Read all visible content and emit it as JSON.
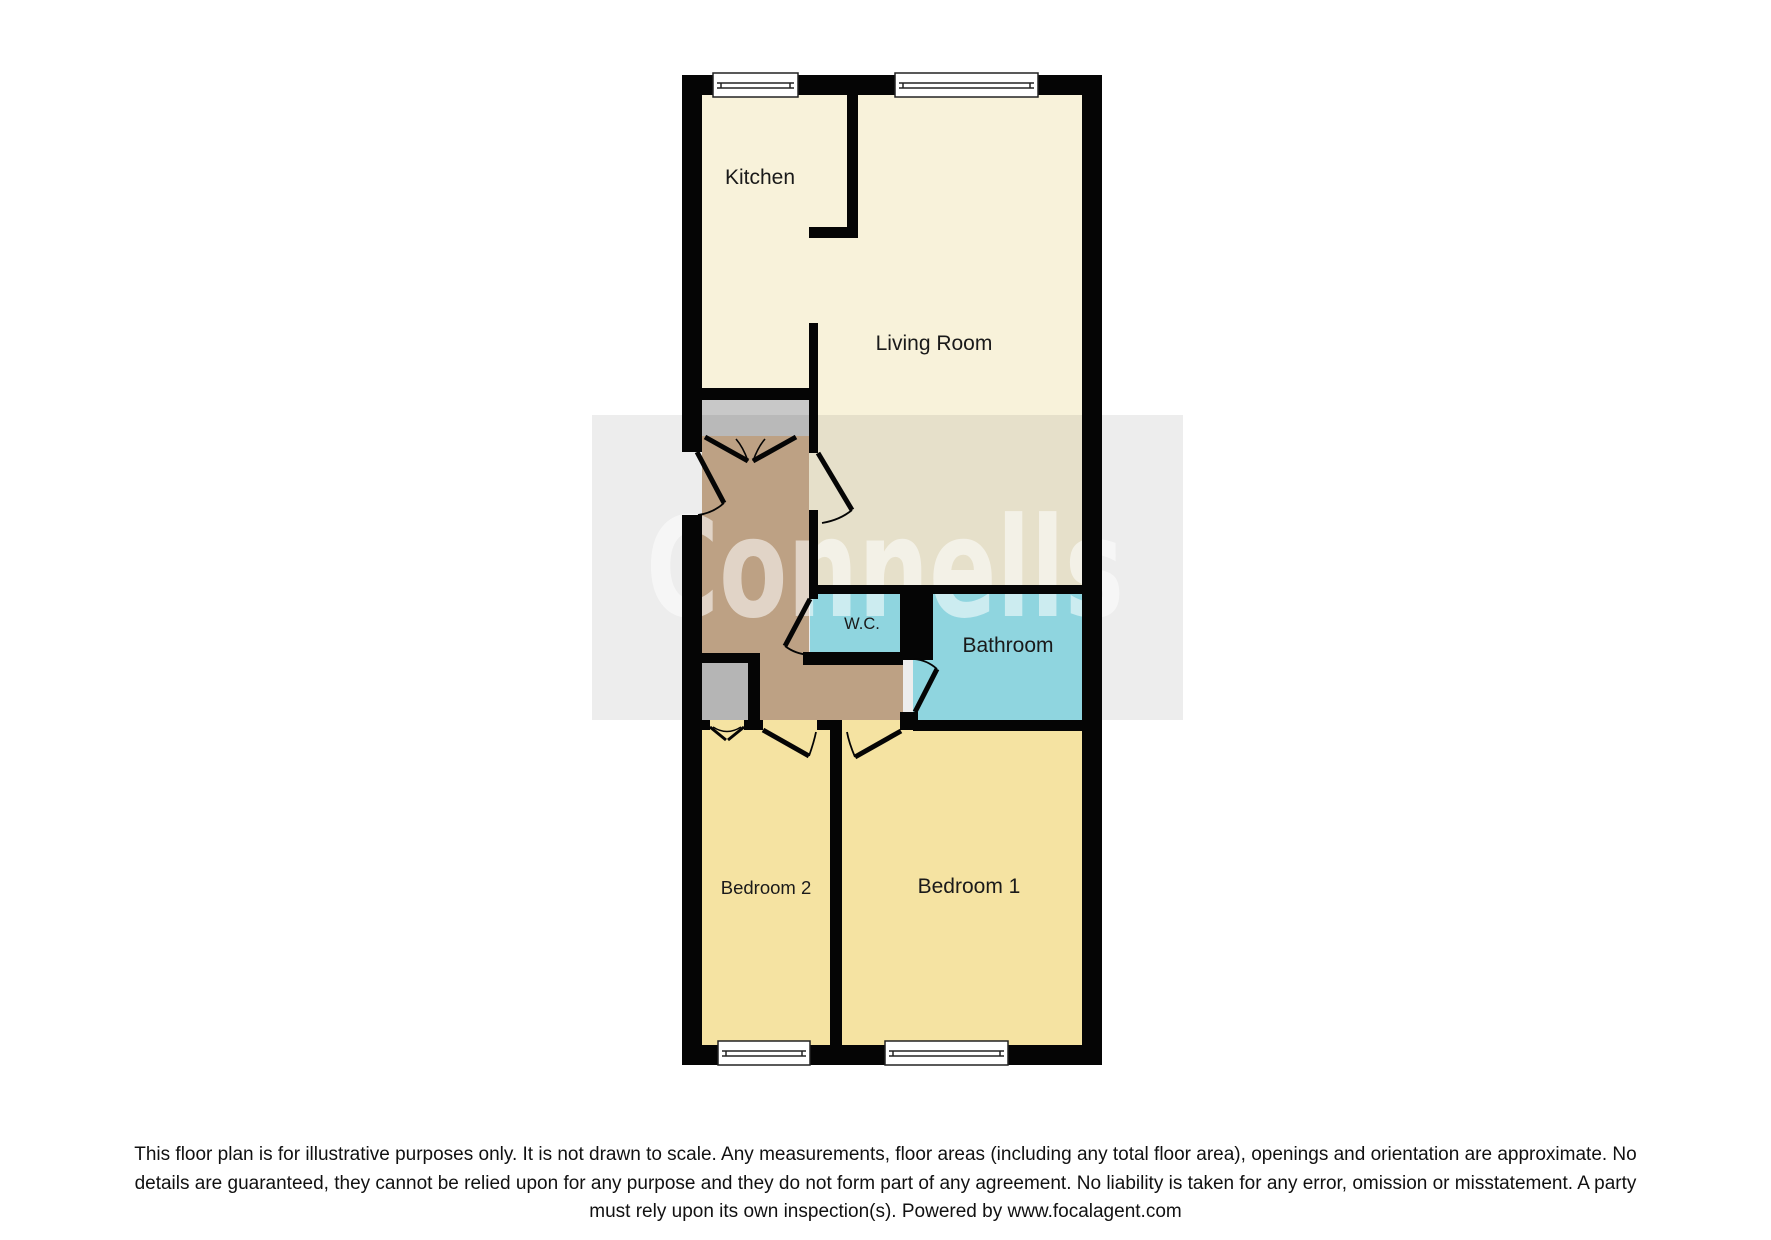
{
  "watermark": {
    "text": "Connells"
  },
  "colors": {
    "wall": "#050505",
    "cream": "#f8f2da",
    "bedroom_yellow": "#f5e3a2",
    "bath_cyan": "#9ae6f0",
    "hall_brown": "#ccae8f",
    "porch_gray": "#c8c8c8",
    "cupboard_gray": "#c3c3c3",
    "window_fill": "#ffffff",
    "label_color": "#1a1a1a"
  },
  "rooms": {
    "kitchen": "Kitchen",
    "living_room": "Living Room",
    "wc": "W.C.",
    "bathroom": "Bathroom",
    "bedroom1": "Bedroom 1",
    "bedroom2": "Bedroom 2"
  },
  "disclaimer": {
    "line1": "This floor plan is for illustrative purposes only. It is not drawn to scale. Any measurements, floor areas (including any total floor area), openings and orientation are approximate. No",
    "line2": "details are guaranteed, they cannot be relied upon for any purpose and they do not form part of any agreement. No liability is taken for any error, omission or misstatement. A party",
    "line3": "must rely upon its own inspection(s). Powered by www.focalagent.com"
  }
}
